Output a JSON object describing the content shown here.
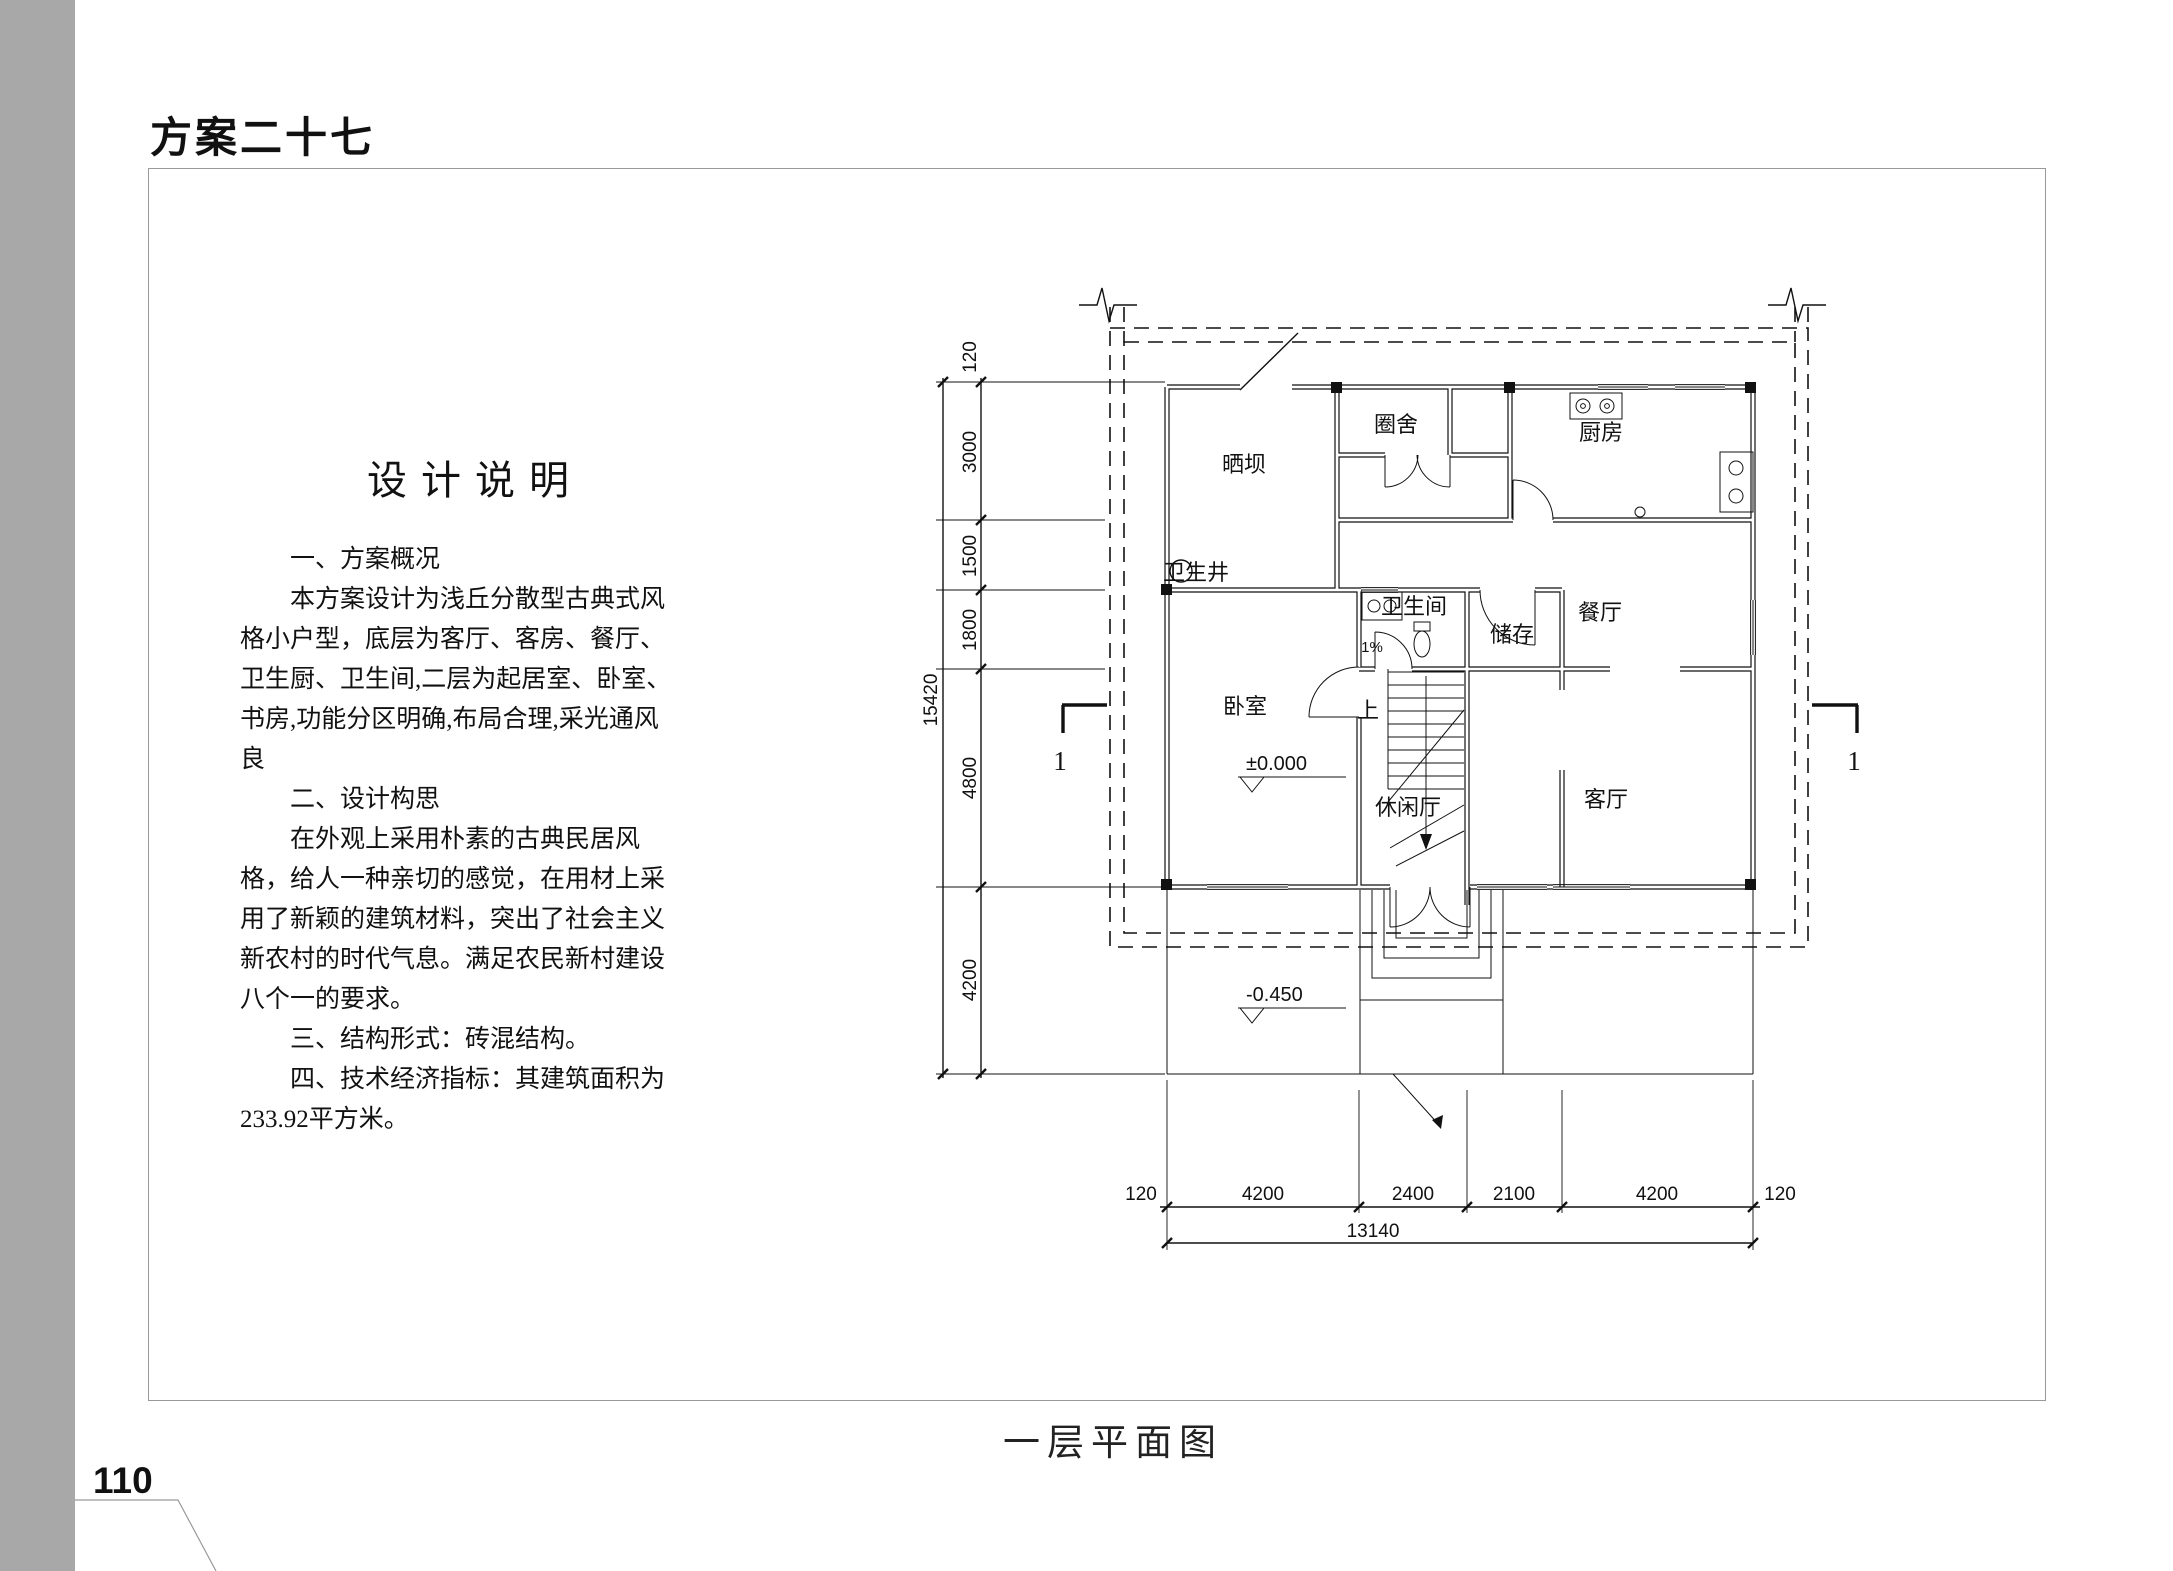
{
  "page": {
    "title": "方案二十七",
    "page_number": "110",
    "caption": "一层平面图"
  },
  "description": {
    "heading": "设计说明",
    "lines": [
      "一、方案概况",
      "本方案设计为浅丘分散型古典式风",
      "格小户型，底层为客厅、客房、餐厅、",
      "卫生厨、卫生间,二层为起居室、卧室、",
      "书房,功能分区明确,布局合理,采光通风",
      "良",
      "二、设计构思",
      "在外观上采用朴素的古典民居风",
      "格，给人一种亲切的感觉，在用材上采",
      "用了新颖的建筑材料，突出了社会主义",
      "新农村的时代气息。满足农民新村建设",
      "八个一的要求。",
      "三、结构形式：砖混结构。",
      "四、技术经济指标：其建筑面积为",
      "233.92平方米。"
    ]
  },
  "plan": {
    "rooms": {
      "shaiba": "晒坝",
      "juanshe": "圈舍",
      "chufang": "厨房",
      "weishengjing": "卫生井",
      "weishengjian": "卫生间",
      "chucun": "储存",
      "canting": "餐厅",
      "woshi": "卧室",
      "shang": "上",
      "xiuxianting": "休闲厅",
      "keting": "客厅",
      "slope": "1%"
    },
    "levels": {
      "ground": "±0.000",
      "yard": "-0.450"
    },
    "section_marks": {
      "left": "1",
      "right": "1"
    },
    "dimensions": {
      "left_chain": [
        "120",
        "3000",
        "1500",
        "1800",
        "4800",
        "4200"
      ],
      "left_total": "15420",
      "bottom_chain": [
        "120",
        "4200",
        "2400",
        "2100",
        "4200",
        "120"
      ],
      "bottom_total": "13140"
    }
  },
  "colors": {
    "line": "#111111",
    "strip": "#a8a8a8",
    "frame": "#999999"
  }
}
